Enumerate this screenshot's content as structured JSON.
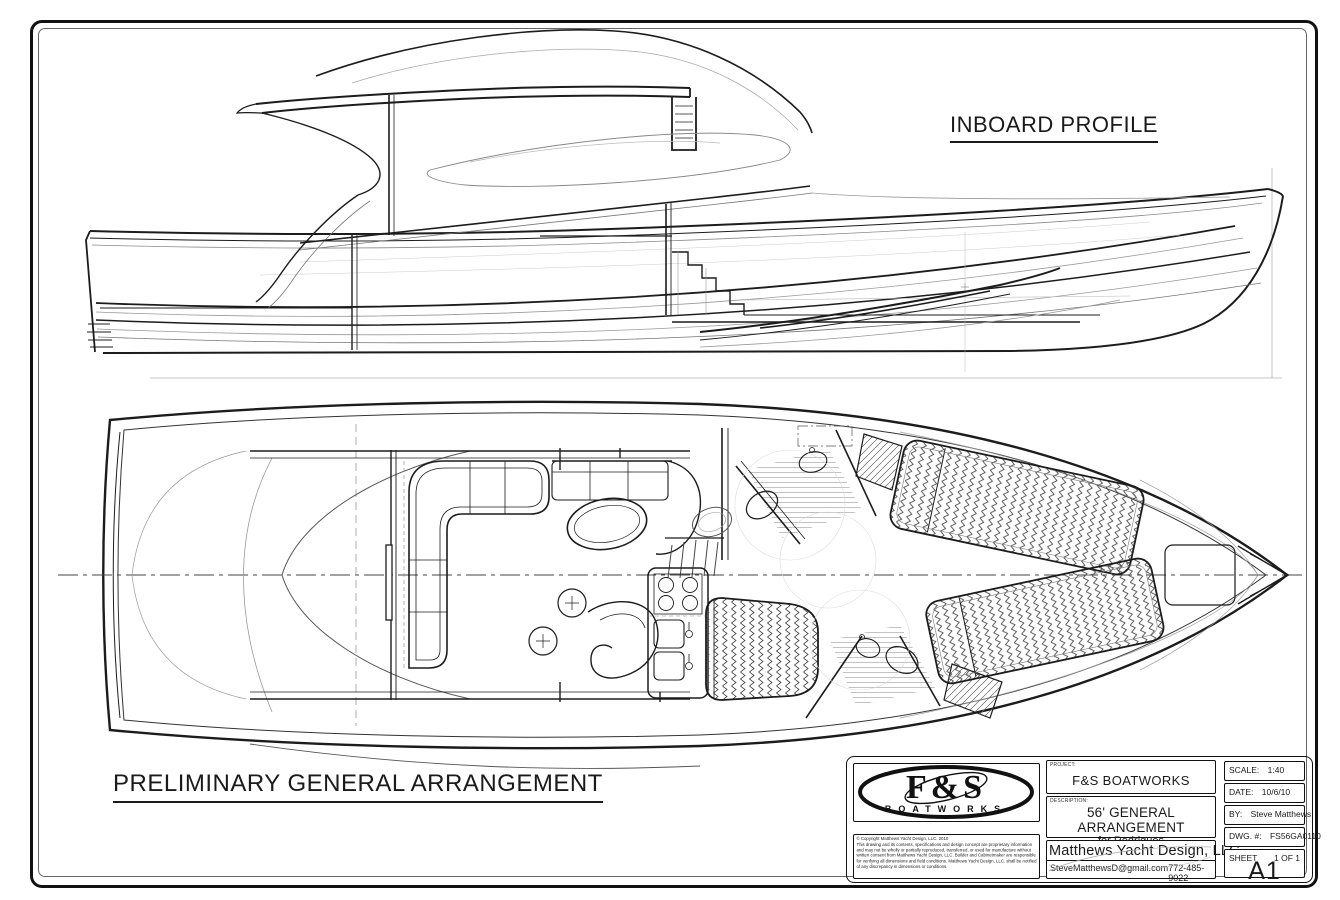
{
  "sheet": {
    "profile_view_label": "INBOARD PROFILE",
    "plan_view_label": "PRELIMINARY GENERAL ARRANGEMENT"
  },
  "title_block": {
    "logo": {
      "name": "F&S",
      "sub": "BOATWORKS"
    },
    "copyright": {
      "line1": "© Copyright Matthews Yacht Design, LLC. 2010",
      "body": "This drawing and its contents, specifications and design concept are proprietary information and may not be wholly or partially reproduced, transferred, or used for manufacture without written consent from Matthews Yacht Design, LLC.  Builder and Cabinetmaker are responsible for verifying all dimensions and field conditions.  Matthews Yacht Design, LLC. shall be notified of any discrepancy in dimensions or conditions."
    },
    "project": {
      "label": "PROJECT:",
      "value": "F&S BOATWORKS"
    },
    "description": {
      "label": "DESCRIPTION:",
      "value": "56' GENERAL ARRANGEMENT",
      "sub": "for Rodrigues"
    },
    "company": {
      "name": "Matthews Yacht Design, LLC.",
      "email": "SteveMatthewsD@gmail.com",
      "phone": "772-485-9022"
    },
    "fields": {
      "scale_label": "SCALE:",
      "scale": "1:40",
      "date_label": "DATE:",
      "date": "10/6/10",
      "by_label": "BY:",
      "by": "Steve Matthews",
      "dwg_label": "DWG. #:",
      "dwg": "FS56GA0110",
      "sheet_label": "SHEET",
      "sheet": "1 OF 1",
      "size": "A1"
    },
    "colors": {
      "ink": "#1a1a1a",
      "mid": "#555555",
      "light": "#999999",
      "paper": "#ffffff"
    }
  }
}
